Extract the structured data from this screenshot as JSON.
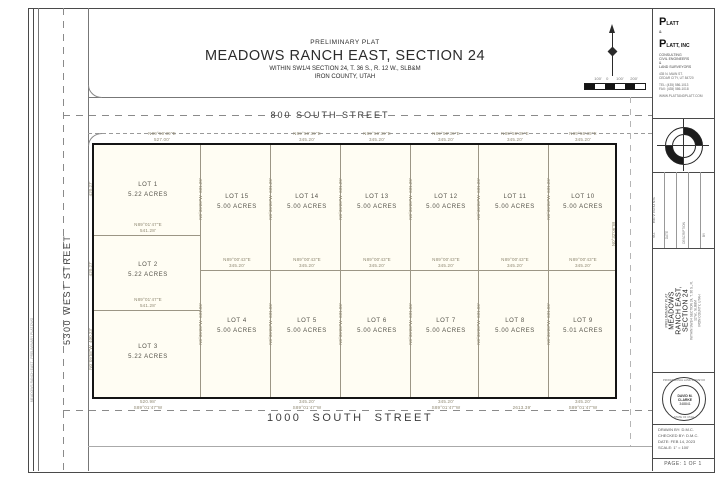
{
  "title_block": {
    "pre": "PRELIMINARY PLAT",
    "title": "MEADOWS RANCH EAST, SECTION 24",
    "legal": "WITHIN SW1/4 SECTION 24, T. 36 S., R. 12 W., SLB&M",
    "county": "IRON COUNTY, UTAH"
  },
  "streets": {
    "north": "800 SOUTH STREET",
    "south": "1000  SOUTH  STREET",
    "west": "5300 WEST STREET"
  },
  "scale": {
    "label": "100'    0       100'      200'"
  },
  "lots": {
    "col": [
      {
        "name": "LOT 1",
        "area": "5.22 ACRES"
      },
      {
        "name": "LOT 2",
        "area": "5.22 ACRES"
      },
      {
        "name": "LOT 3",
        "area": "5.22 ACRES"
      }
    ],
    "top": [
      {
        "name": "LOT 15",
        "area": "5.00 ACRES"
      },
      {
        "name": "LOT 14",
        "area": "5.00 ACRES"
      },
      {
        "name": "LOT 13",
        "area": "5.00 ACRES"
      },
      {
        "name": "LOT 12",
        "area": "5.00 ACRES"
      },
      {
        "name": "LOT 11",
        "area": "5.00 ACRES"
      },
      {
        "name": "LOT 10",
        "area": "5.00 ACRES"
      }
    ],
    "bottom": [
      {
        "name": "LOT 4",
        "area": "5.00 ACRES"
      },
      {
        "name": "LOT 5",
        "area": "5.00 ACRES"
      },
      {
        "name": "LOT 6",
        "area": "5.00 ACRES"
      },
      {
        "name": "LOT 7",
        "area": "5.00 ACRES"
      },
      {
        "name": "LOT 8",
        "area": "5.00 ACRES"
      },
      {
        "name": "LOT 9",
        "area": "5.01 ACRES"
      }
    ]
  },
  "bearings": {
    "top": [
      {
        "b": "N89°59'39\"E",
        "d": "527.00'"
      },
      {
        "b": "N89°59'39\"E",
        "d": "345.20'"
      },
      {
        "b": "N89°59'39\"E",
        "d": "345.20'"
      },
      {
        "b": "N89°59'39\"E",
        "d": "345.20'"
      },
      {
        "b": "N89°59'39\"E",
        "d": "345.20'"
      },
      {
        "b": "N89°59'39\"E",
        "d": "345.20'"
      }
    ],
    "mid": [
      {
        "b": "N89°00'43\"E",
        "d": "345.20'"
      },
      {
        "b": "N89°00'43\"E",
        "d": "345.20'"
      },
      {
        "b": "N89°00'43\"E",
        "d": "345.20'"
      },
      {
        "b": "N89°00'43\"E",
        "d": "345.20'"
      },
      {
        "b": "N89°00'43\"E",
        "d": "345.20'"
      },
      {
        "b": "N89°00'43\"E",
        "d": "345.20'"
      }
    ],
    "col": [
      {
        "b": "N89°01'47\"E",
        "d": "541.28'"
      },
      {
        "b": "N89°01'47\"E",
        "d": "541.28'"
      }
    ],
    "bottom": [
      {
        "d": "520.98'",
        "b": "S89°01'47\"W"
      },
      {
        "d": "345.20'",
        "b": "S89°01'47\"W"
      },
      {
        "d": "345.20'",
        "b": "S89°01'47\"W"
      },
      {
        "d": "345.20'",
        "b": "S89°01'47\"W"
      }
    ],
    "total": "2613.39'",
    "vtop": "N0°30'20\"W  631.26'",
    "vbot": "N0°30'20\"W  631.06'",
    "west": [
      "420.27'",
      "420.27'",
      "N0°09'58\"W  400.23'"
    ],
    "east": "N0°32'06\"W"
  },
  "sidebar": {
    "logo": {
      "p1": "P",
      "p1b": "LATT",
      "amp": "&",
      "p2": "P",
      "p2b": "LATT, INC",
      "sub1": "CONSULTING",
      "sub2": "CIVIL ENGINEERS",
      "sub3": "&",
      "sub4": "LAND SURVEYORS",
      "addr1": "435 N. MAIN ST.",
      "addr2": "CEDAR CITY, UT 84720",
      "tel": "TEL: (435) 586-1013",
      "fax": "FAX: (435) 586-1018",
      "web": "WWW.PLATTANDPLATT.COM"
    },
    "revisions_label": "REVISIONS",
    "rev_cols": [
      "NO.",
      "DATE",
      "DESCRIPTION",
      "BY"
    ],
    "seal": {
      "ring_top": "PROFESSIONAL LAND SURVEYOR",
      "name": "DAVID M. CLARKE",
      "number": "348841",
      "ring_bottom": "STATE OF UTAH"
    },
    "info": [
      {
        "label": "DRAWN BY:",
        "value": "D.M.C."
      },
      {
        "label": "CHECKED BY:",
        "value": "D.M.C."
      },
      {
        "label": "DATE:",
        "value": "FEB 14, 2023"
      },
      {
        "label": "SCALE:",
        "value": "1\" = 100'"
      }
    ],
    "page": "PAGE: 1 OF 1"
  },
  "margin_note": "MEADOWS RANCH EAST - PRELIMINARY PLAT.DWG"
}
